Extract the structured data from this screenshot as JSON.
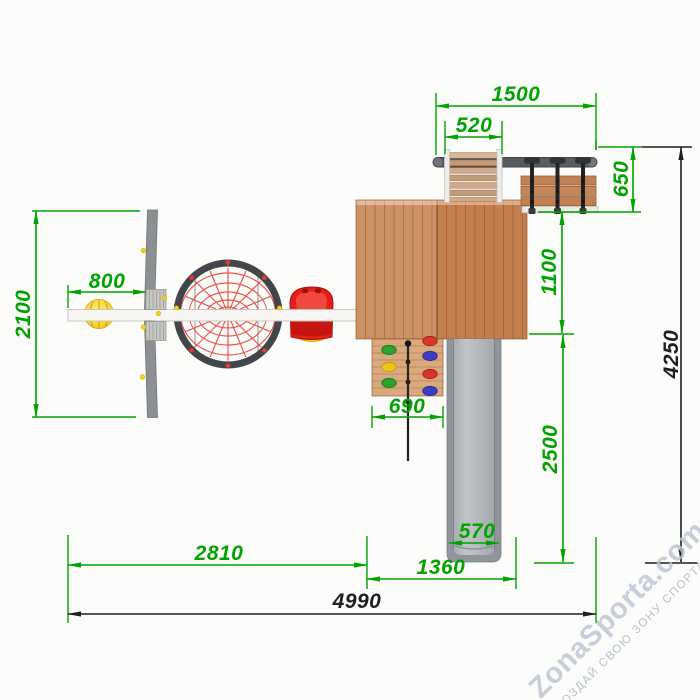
{
  "watermark": {
    "brand": "ZonaSporta.com",
    "tagline": "СОЗДАЙ СВОЮ ЗОНУ СПОРТА"
  },
  "dimensions": {
    "top_frame_width": {
      "value": "1500"
    },
    "ladder_width": {
      "value": "520"
    },
    "bench_depth": {
      "value": "650"
    },
    "platform_side_depth": {
      "value": "1100"
    },
    "swing_frame_depth": {
      "value": "2100"
    },
    "swing_bay_width": {
      "value": "800"
    },
    "climbing_wall_width": {
      "value": "690"
    },
    "slide_run_depth": {
      "value": "2500"
    },
    "overall_depth": {
      "value": "4250"
    },
    "slide_width": {
      "value": "570"
    },
    "slide_zone_width": {
      "value": "1360"
    },
    "swing_zone_width": {
      "value": "2810"
    },
    "overall_width": {
      "value": "4990"
    }
  },
  "palette": {
    "dimension_green": "#00A300",
    "dimension_black": "#1F1F1F",
    "wood": "#C9895B",
    "wood_light": "#DAA97D",
    "metal_gray": "#8C9093",
    "slide_gray": "#B4B8BB",
    "net_red": "#E8564A",
    "seat_red": "#E31F18",
    "ball_yellow": "#F7D93E",
    "watermark_blue": "#B9C5D3"
  }
}
